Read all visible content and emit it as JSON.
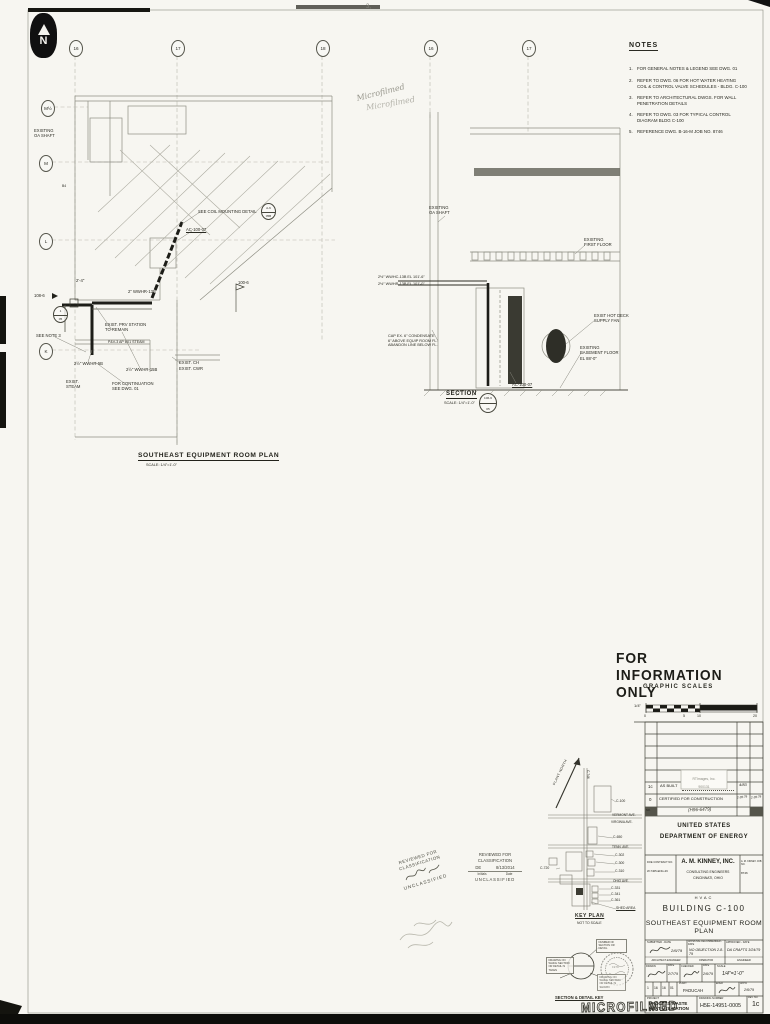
{
  "colors": {
    "paper": "#f7f6f1",
    "ink": "#2a2a22",
    "heavy_ink": "#101010"
  },
  "page": {
    "corner_mark": "3,",
    "microfilm_script": "Microfilmed",
    "microfilm_stamp": "MICROFILMED"
  },
  "north": {
    "label": "N"
  },
  "bubbles": {
    "top": [
      "16",
      "17",
      "18",
      "16",
      "17"
    ],
    "left": [
      "M½",
      "M",
      "L",
      "K"
    ]
  },
  "notes": {
    "title": "NOTES",
    "items": [
      {
        "no": "1.",
        "text": "FOR GENERAL NOTES & LEGEND SEE DWG. 01"
      },
      {
        "no": "2.",
        "text": "REFER TO DWG. 06 FOR HOT WATER HEATING\nCOIL & CONTROL VALVE SCHEDULES - BLDG. C-100"
      },
      {
        "no": "3.",
        "text": "REFER TO ARCHITECTURAL DWGS. FOR WALL\nPENETRATION DETAILS"
      },
      {
        "no": "4.",
        "text": "REFER TO DWG. 03 FOR TYPICAL CONTROL\nDIAGRAM BLDG C-100"
      },
      {
        "no": "5.",
        "text": "REFERENCE DWG. B-16-M JOB NO. 8746"
      }
    ]
  },
  "plan": {
    "title": "SOUTHEAST EQUIPMENT ROOM PLAN",
    "scale": "SCALE: 1/4\"=1'-0\"",
    "labels": [
      "EXISTING\nOA SHAFT",
      "SEE COIL MOUNTING DETAIL",
      "AC-100-07",
      "2'-4\"",
      "2\" WWHR-13B",
      "108-6",
      "EXIST. PRV STATION\nTO REMAIN",
      "SEE NOTE 3",
      "P&V-3  AP 6X1 STEAM",
      "2½\" WWHR-5B",
      "2½\" WWHR-15B",
      "EXIST.\nSTEAM",
      "FOR CONTINUATION\nSEE DWG. 01",
      "EXIST. CH",
      "EXIST. CWR",
      "100-6",
      "B4"
    ],
    "db1": {
      "top": "A-6",
      "bottom": "05B"
    },
    "db2": {
      "top": "1",
      "bottom": "05"
    }
  },
  "section": {
    "title": "SECTION",
    "scale": "SCALE: 1/4\"=1'-0\"",
    "labels": [
      "EXISTING\nOA SHAFT",
      "2½\" WWHC-13B  EL 101'-6\"",
      "2½\" WWHR-13B  EL 101'-0\"",
      "EXISTING\nFIRST FLOOR",
      "EXIST HOT DECK\nSUPPLY FAN",
      "EXISTING\nBASEMENT FLOOR\nEL 88'-0\"",
      "CAP EX. 6\" CONDENSATE\n6\" ABOVE EQUIP ROOM FL.\nABANDON LINE BELOW FL.",
      "AC-100-07"
    ],
    "db": {
      "top": "106-6",
      "bottom": "05"
    }
  },
  "info_only": "FOR INFORMATION ONLY",
  "scales": {
    "title": "GRAPHIC SCALES",
    "unit": "1/4\"",
    "ticks": [
      "0",
      "5",
      "10",
      "20"
    ]
  },
  "key_plan": {
    "north": "PLANT NORTH",
    "streets": [
      "VERMONT AVE.",
      "VIRGINIA AVE.",
      "TENN. AVE.",
      "OHIO AVE."
    ],
    "buildings": [
      "C-746",
      "C-100",
      "C-650",
      "C-302",
      "C-300",
      "C-310",
      "C-720",
      "C-331",
      "C-341",
      "C-361"
    ],
    "shed": "SHED AREA",
    "title": "KEY PLAN",
    "subtitle": "NOT TO SCALE"
  },
  "stamps": {
    "diag": {
      "line1": "REVIEWED FOR",
      "line2": "CLASSIFICATION",
      "result": "UNCLASSIFIED"
    },
    "box": {
      "line1": "REVIEWED FOR",
      "line2": "CLASSIFICATION",
      "initials": "DE",
      "date": "8/13/2014",
      "initials_label": "Initials",
      "date_label": "Date",
      "result": "UNCLASSIFIED"
    },
    "seal_year": "1979"
  },
  "detail_key": {
    "caption": "SECTION & DETAIL KEY",
    "top_label": "NUMBER OF\nSECTION OR\nDETAIL",
    "left_label": "DRAWING ON\nWHICH SECTION\nOR DETAIL IS\nTAKEN",
    "right_label": "DRAWING ON\nWHICH SECTION\nOR DETAIL IS\nSHOWN"
  },
  "title_block": {
    "rev_rows": [
      {
        "no": "1c",
        "desc": "AS BUILT",
        "date": "4/83",
        "appd": ""
      },
      {
        "no": "0",
        "desc": "CERTIFIED FOR CONSTRUCTION",
        "date": "2-28-79",
        "appd": "2-28-79"
      }
    ],
    "no_label": "NO.",
    "hand_note": "(H96-6479)",
    "photo_stamp_1": "RTImages, Inc.",
    "photo_stamp_2": "900131",
    "agency1": "UNITED STATES",
    "agency2": "DEPARTMENT OF ENERGY",
    "contract_label": "DOE CONTRACT NO.",
    "contract_no": "W-7405-ENG-26",
    "firm": "A. M. KINNEY, INC.",
    "firm2": "CONSULTING ENGINEERS",
    "firm3": "CINCINNATI, OHIO",
    "job_label": "A. M. KINNEY JOB NO.",
    "job_no": "8746",
    "discipline": "HVAC",
    "building": "BUILDING C-100",
    "sheet_title": "SOUTHEAST EQUIPMENT ROOM PLAN",
    "submitted_label": "SUBMITTED - DATE",
    "submitted_date": "2/6/79",
    "submitted_foot": "ARCHITECT-ENGINEER",
    "approval_label": "APPROVAL RECOMMENDED - DATE",
    "approval_value": "NO OBJECTION 2-8-79",
    "approval_foot": "OPERATOR",
    "approved_label": "APPROVED - DATE",
    "approved_value": "DA CRAFTS 3/24/79",
    "approved_foot": "ENGINEER",
    "drawn_label": "DRAWN",
    "date_label": "DATE",
    "drawn_date": "2/7/79",
    "checked_label": "CHECKED",
    "checked_date": "2/6/79",
    "scale_label": "SCALE",
    "scale_value": "1/4\"=1'-0\"",
    "small_cells": [
      "1",
      "16",
      "16",
      "01"
    ],
    "plant_label": "PLANT",
    "plant_value": "PADUCAH",
    "engr_label": "ENGR",
    "appd_label": "APP'D",
    "appd_date": "2/6/79",
    "project_label": "PROJECT",
    "project_value": "PROCESS WASTE\nHEAT UTILIZATION",
    "number_label": "DRAWING NUMBER",
    "number_value": "H5E-14951-0005",
    "rev_label": "REV. NO.",
    "rev_value": "1c"
  }
}
